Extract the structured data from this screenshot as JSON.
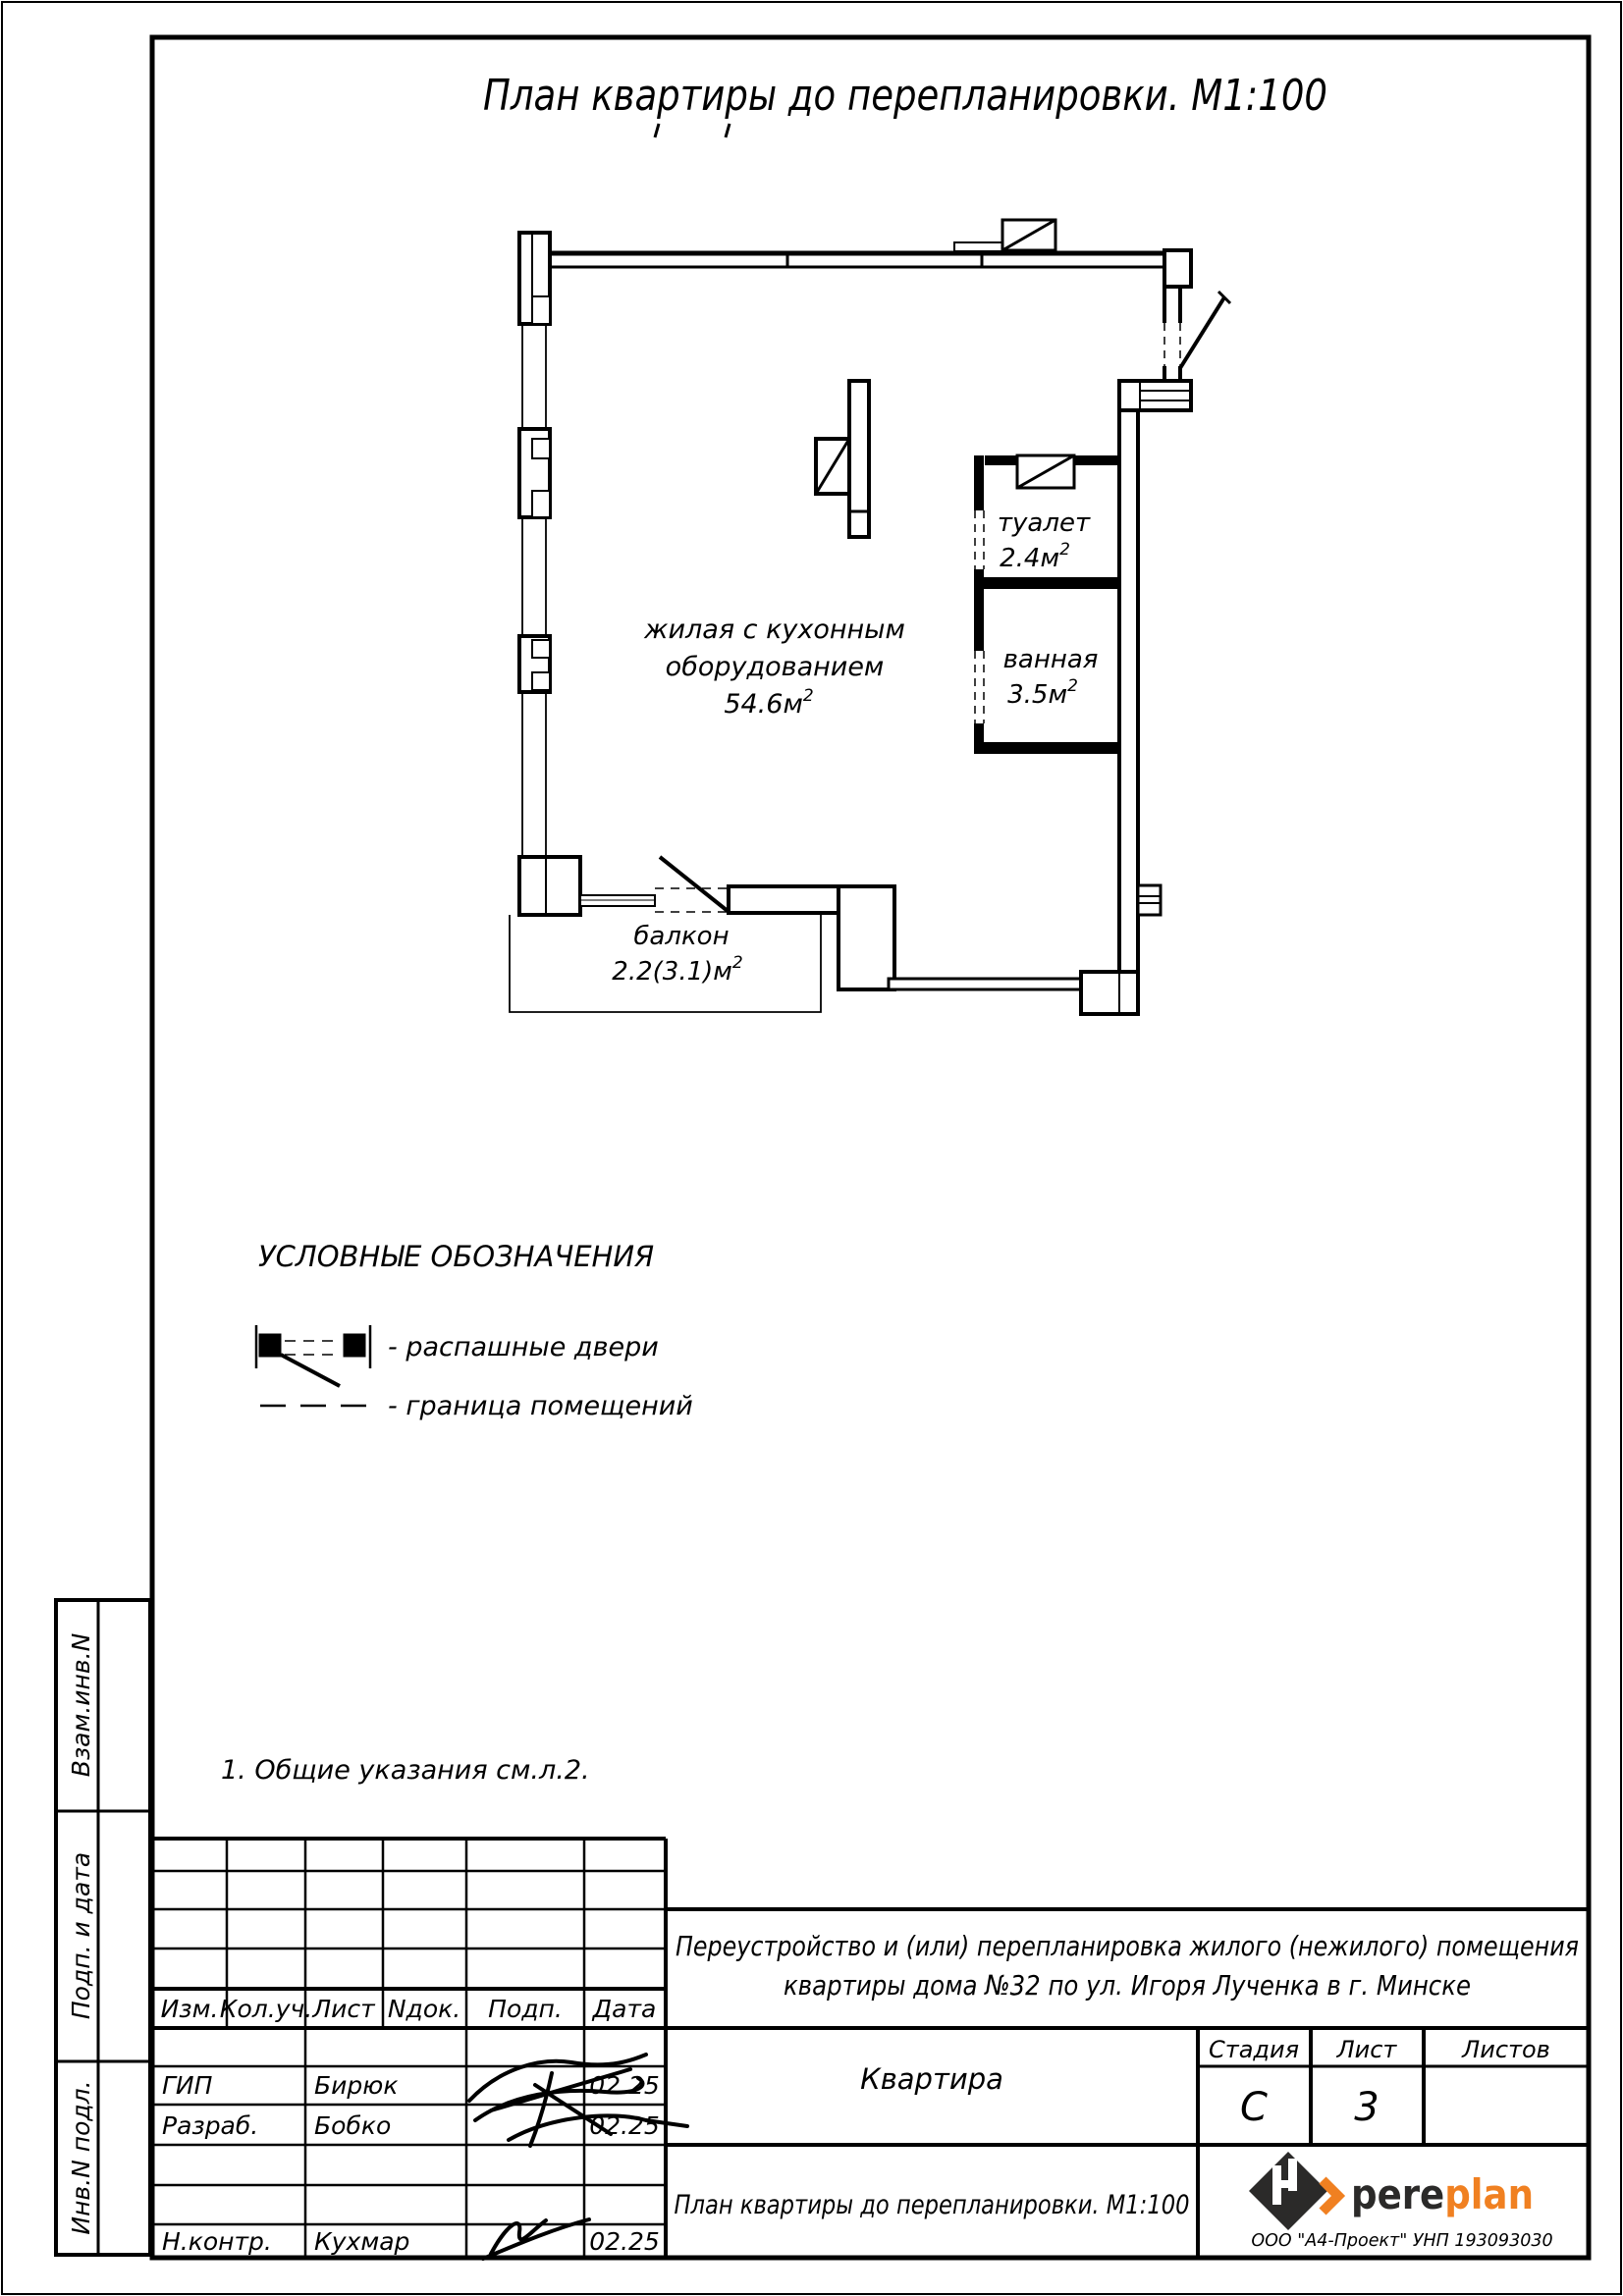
{
  "sheet": {
    "title": "План квартиры до перепланировки. М1:100",
    "note": "1. Общие указания см.л.2."
  },
  "plan": {
    "rooms": [
      {
        "line1": "жилая с кухонным",
        "line2": "оборудованием",
        "area": "54.6м",
        "sup": "2"
      },
      {
        "name": "туалет",
        "area": "2.4м",
        "sup": "2"
      },
      {
        "name": "ванная",
        "area": "3.5м",
        "sup": "2"
      },
      {
        "name": "балкон",
        "area": "2.2(3.1)м",
        "sup": "2"
      }
    ]
  },
  "legend": {
    "heading": "УСЛОВНЫЕ ОБОЗНАЧЕНИЯ",
    "items": [
      {
        "label": "- распашные двери"
      },
      {
        "label": "- граница помещений"
      }
    ]
  },
  "sidebar": {
    "labels": [
      "Взам.инв.N",
      "Подп. и дата",
      "Инв.N подл."
    ]
  },
  "titleblock": {
    "columns": [
      "Изм.",
      "Кол.уч.",
      "Лист",
      "Nдок.",
      "Подп.",
      "Дата"
    ],
    "rows": [
      {
        "role": "ГИП",
        "name": "Бирюк",
        "date": "02.25"
      },
      {
        "role": "Разраб.",
        "name": "Бобко",
        "date": "02.25"
      },
      {
        "role": "Н.контр.",
        "name": "Кухмар",
        "date": "02.25"
      }
    ],
    "project_line1": "Переустройство и (или) перепланировка жилого (нежилого) помещения",
    "project_line2": "квартиры дома  №32  по ул. Игоря Лученка в г. Минске",
    "object": "Квартира",
    "stage_label": "Стадия",
    "sheet_label": "Лист",
    "sheets_label": "Листов",
    "stage": "С",
    "sheet_no": "3",
    "sheets_total": "",
    "doc_title": "План квартиры до перепланировки. М1:100",
    "logo": {
      "text_black": "pere",
      "text_orange": "plan",
      "sub": "ООО  \"А4-Проект\"  УНП 193093030",
      "orange": "#F08021",
      "dark": "#2B2A29"
    }
  }
}
